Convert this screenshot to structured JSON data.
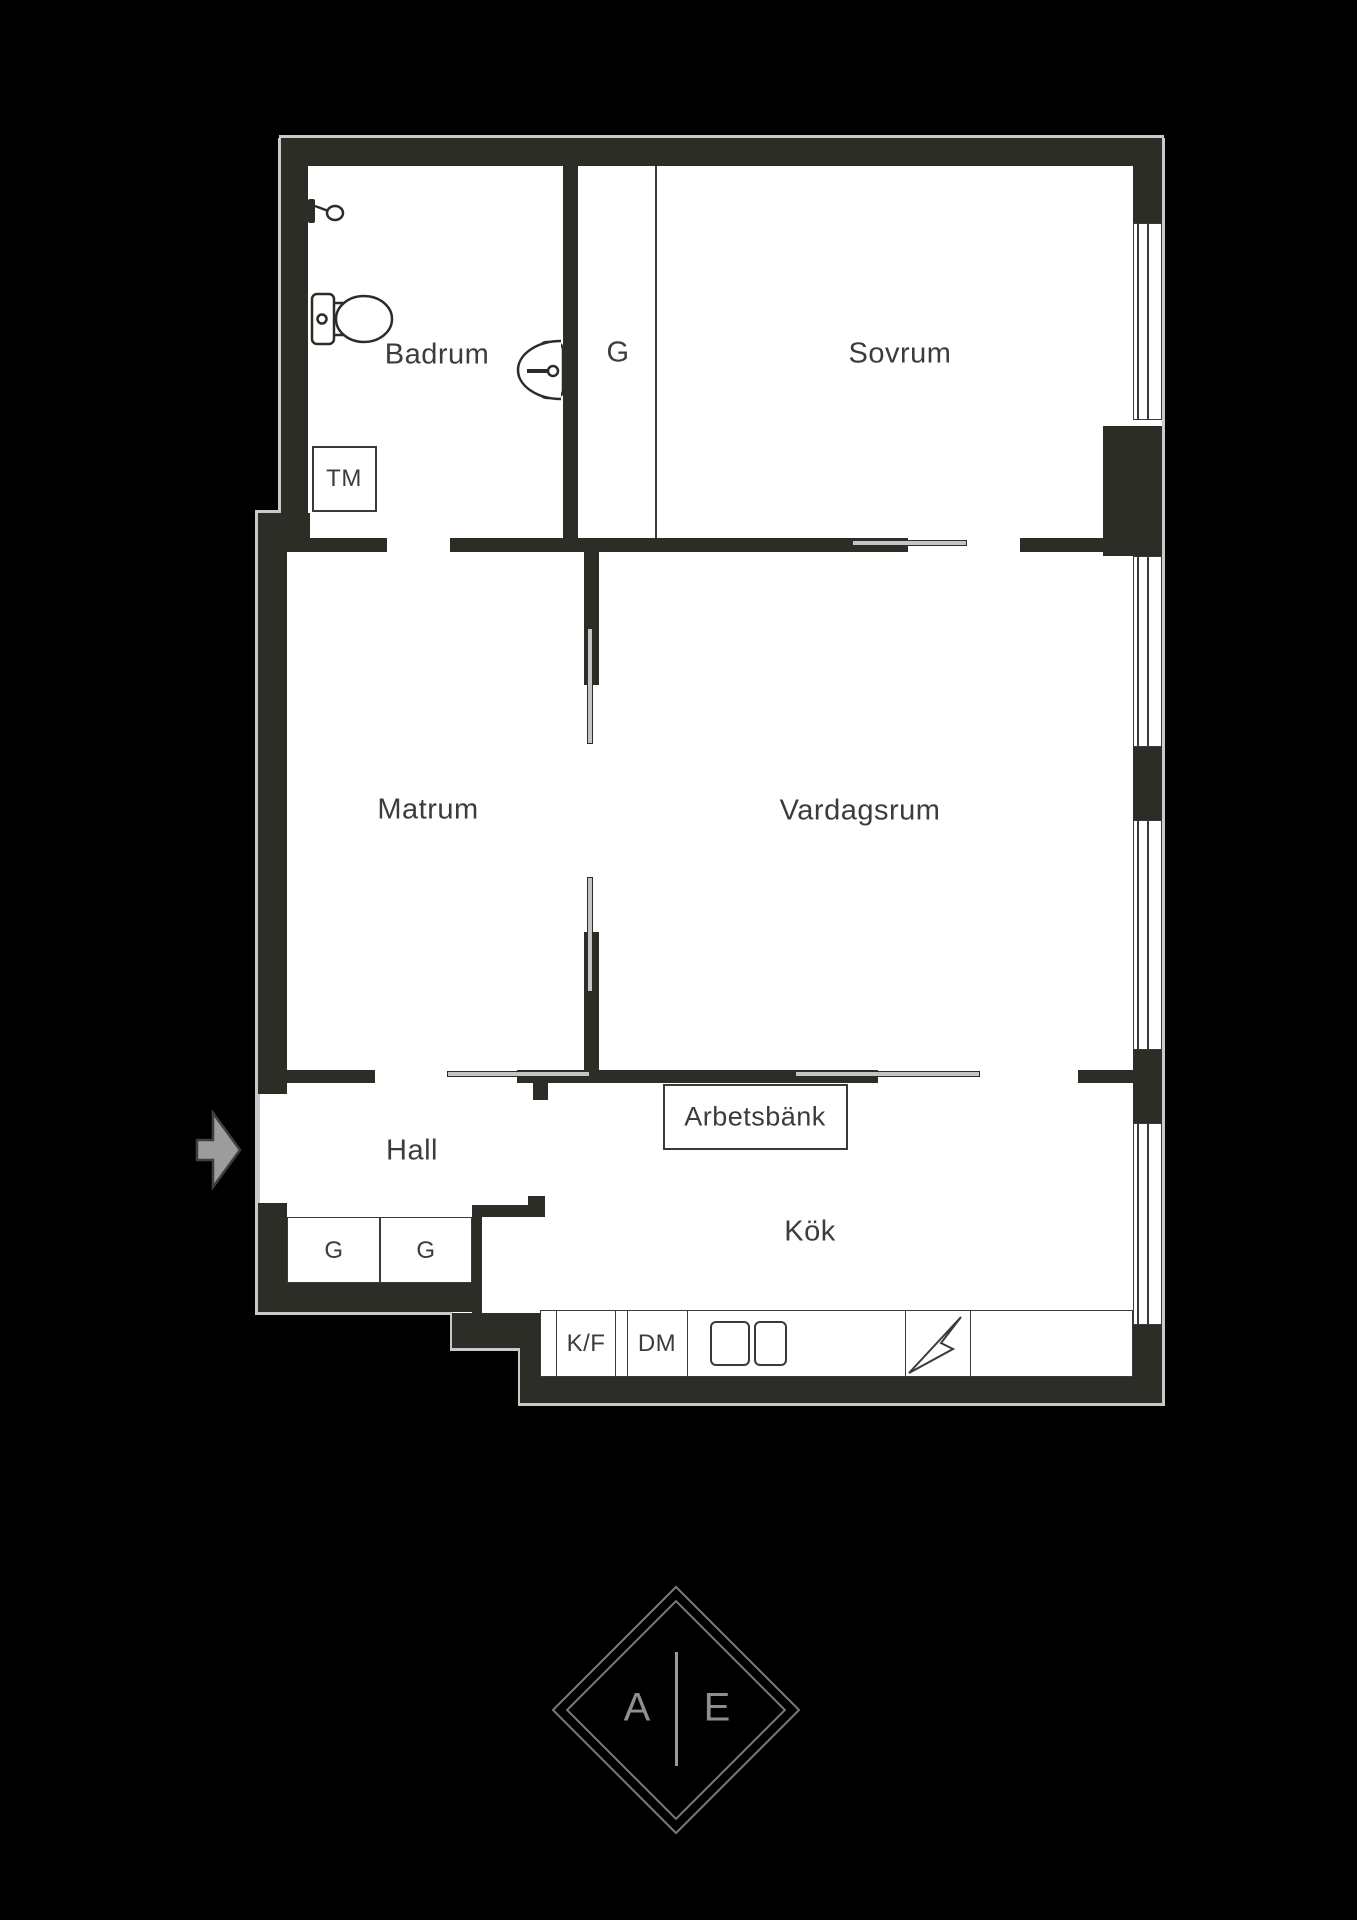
{
  "plan": {
    "type": "apartment-floor-plan",
    "rooms": [
      {
        "id": "badrum",
        "label": "Badrum"
      },
      {
        "id": "garderob-top",
        "label": "G"
      },
      {
        "id": "sovrum",
        "label": "Sovrum"
      },
      {
        "id": "matrum",
        "label": "Matrum"
      },
      {
        "id": "vardagsrum",
        "label": "Vardagsrum"
      },
      {
        "id": "hall",
        "label": "Hall"
      },
      {
        "id": "kok",
        "label": "Kök"
      }
    ],
    "units": {
      "washing_machine": "TM",
      "hall_closet_1": "G",
      "hall_closet_2": "G",
      "workbench": "Arbetsbänk",
      "fridge_freezer": "K/F",
      "dishwasher": "DM"
    },
    "icons": {
      "shower": "shower-icon",
      "toilet": "toilet-icon",
      "sink": "sink-icon",
      "hob": "hob-icon",
      "stove": "stove-lightning-icon",
      "entry": "entry-arrow-icon",
      "window": "window-glyph",
      "sliding_door": "sliding-door-glyph"
    },
    "colors": {
      "background": "#000000",
      "wall": "#2d2d28",
      "floor": "#ffffff",
      "outline": "#3a3a3a",
      "text": "#3c3c3c",
      "arrow_fill": "#9c9c9c",
      "logo_line": "#8f8f8f"
    }
  },
  "logo": {
    "letter_left": "A",
    "letter_right": "E"
  }
}
